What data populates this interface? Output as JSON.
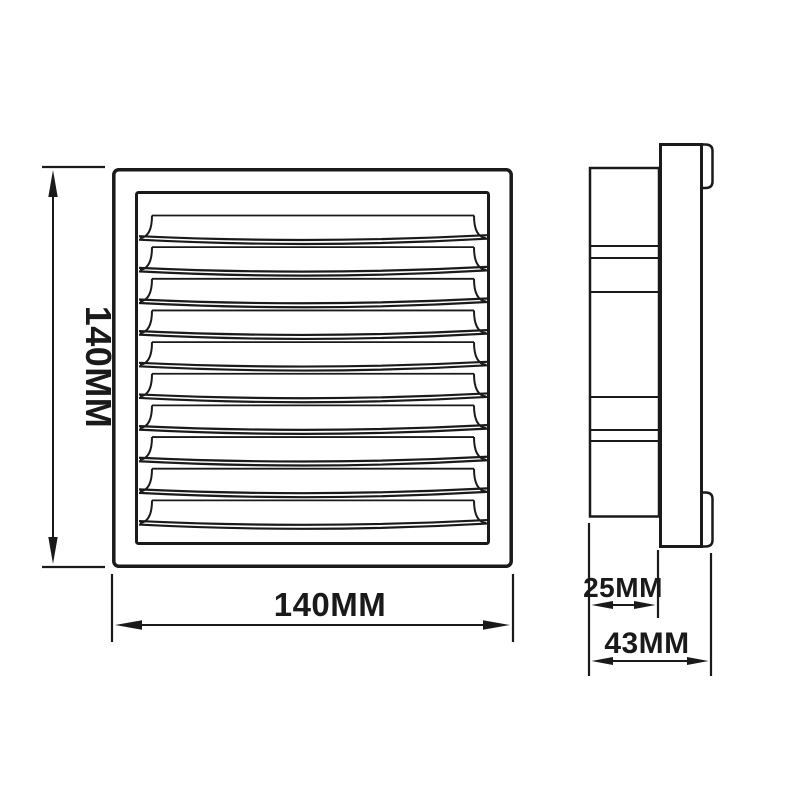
{
  "drawing": {
    "background_color": "#ffffff",
    "line_color": "#1a1a1a",
    "front_view": {
      "height_label": "140MM",
      "width_label": "140MM",
      "louver_count": 10
    },
    "side_view": {
      "inner_depth_label": "25MM",
      "total_depth_label": "43MM"
    }
  }
}
